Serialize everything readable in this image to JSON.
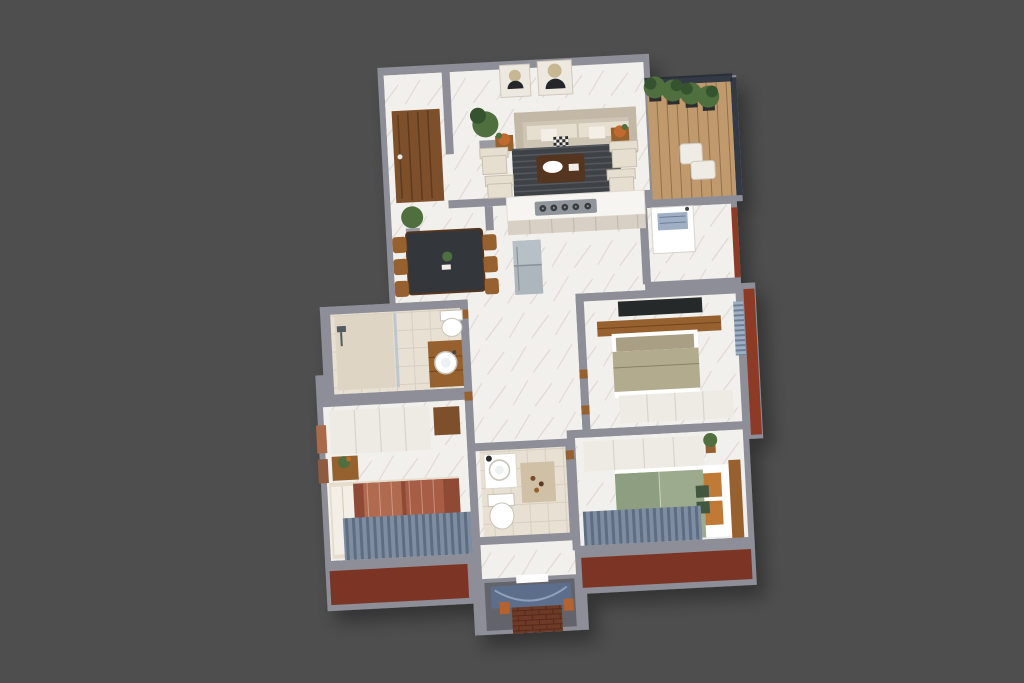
{
  "scene": {
    "description": "3D isometric cutaway floor plan render of a 3-bedroom apartment on a plain gray backdrop",
    "background": "#4e4e4e",
    "rotation_deg": -3,
    "visible_text": "none"
  },
  "palette": {
    "background": "#4e4e4e",
    "wall": "#8e8e98",
    "wall-light": "#b7b7c0",
    "wall-dark": "#6f6f79",
    "floor": "#f2f0ec",
    "floor-vein": "#dcd7d0",
    "floor-tile": "#e8e0d2",
    "tile-line": "#d8cfc0",
    "wood-door": "#7d4f2a",
    "wood-deck": "#c09a6d",
    "wood-dark": "#54351f",
    "wood-mid": "#96602f",
    "terracotta": "#7c3424",
    "brick": "#6e3a28",
    "brick-line": "#58281a",
    "rust-wall": "#8d3b26",
    "sofa": "#cfc5b5",
    "sofa-back": "#c3b8a6",
    "cushion": "#e6dfd0",
    "pillow-white": "#f3efe6",
    "rug-dark": "#3e4246",
    "rug-stripe": "#565b60",
    "rug-beige": "#cfc0a6",
    "table-dark": "#33363a",
    "counter": "#f7f5f1",
    "cabinet": "#d8d0c5",
    "cabinet-line": "#c4bbae",
    "steel": "#aeb6bd",
    "steel-light": "#b8c0c7",
    "hob": "#8f959b",
    "burner": "#3a3d40",
    "bed-rust": "#8f4a36",
    "bed-rust2": "#b06a50",
    "bed-rust3": "#a85e46",
    "bed-sage": "#9cab8d",
    "bed-sage2": "#8e9e80",
    "bed-olive": "#b3ab8e",
    "bed-taupe": "#a89f85",
    "pillow": "#e6ddcc",
    "pillow-orange": "#c07a35",
    "pillow-green": "#41573f",
    "wardrobe": "#eeebe5",
    "wardrobe-line": "#d8d4cc",
    "curtain": "#7f8da1",
    "curtain-dark": "#5f6d83",
    "blind": "#9fb0c4",
    "blind-dark": "#6e7f95",
    "tv": "#26292a",
    "glass": "#232a36",
    "plant": "#4f6f3f",
    "plant-dark": "#35532e",
    "pot-dark": "#2d2d2d",
    "white": "#ffffff",
    "porch-floor": "#63636b",
    "porch-drape": "#5d6e8c",
    "porch-arc": "#8fa0ba",
    "accent-orange": "#b5622f",
    "flower-orange": "#c06a2e",
    "frame": "#eee9e0",
    "frame-line": "#cfc8bb",
    "art-dark": "#24262a",
    "art-tan": "#c7b793",
    "basin-stroke": "#c9c2b6",
    "pot-gray": "#9a9aa0"
  },
  "rooms": [
    {
      "name": "entry-foyer",
      "floor": "white-marble",
      "furniture": [
        "wood-entry-door",
        "potted-plant"
      ]
    },
    {
      "name": "living-room",
      "floor": "white-marble",
      "furniture": [
        "three-seat-sofa",
        "four-armchairs",
        "coffee-table",
        "striped-dark-rug",
        "two-wall-art-frames",
        "two-flower-stands",
        "potted-plant"
      ]
    },
    {
      "name": "balcony",
      "floor": "wood-deck",
      "furniture": [
        "four-potted-trees",
        "lounge-chair",
        "glass-railing"
      ]
    },
    {
      "name": "dining-area",
      "floor": "white-marble",
      "furniture": [
        "dark-stone-dining-table",
        "six-wood-chairs",
        "centerpiece",
        "potted-plant"
      ]
    },
    {
      "name": "kitchen",
      "floor": "white-marble",
      "furniture": [
        "island-counter",
        "five-burner-gas-hob",
        "refrigerator"
      ]
    },
    {
      "name": "utility-room",
      "floor": "white-marble",
      "furniture": [
        "wash-basin-unit"
      ]
    },
    {
      "name": "bedroom-middle",
      "floor": "white-marble",
      "furniture": [
        "wall-tv-panel",
        "wood-media-bench",
        "double-bed-olive",
        "white-wardrobe",
        "window-blinds"
      ]
    },
    {
      "name": "bathroom-main",
      "floor": "beige-tile",
      "furniture": [
        "walk-in-shower",
        "glass-partition",
        "wood-vanity-round-basin",
        "toilet"
      ]
    },
    {
      "name": "bedroom-left",
      "floor": "white-marble",
      "furniture": [
        "white-wardrobe",
        "wood-door",
        "side-table-plant",
        "double-bed-rust",
        "blue-gray-curtains",
        "wall-art"
      ]
    },
    {
      "name": "bathroom-small",
      "floor": "beige-tile",
      "furniture": [
        "white-vanity-round-basin",
        "toilet",
        "beige-rug"
      ]
    },
    {
      "name": "bedroom-right",
      "floor": "white-marble",
      "furniture": [
        "white-wardrobe",
        "double-bed-sage",
        "wood-headboard",
        "orange-and-green-pillows",
        "blue-gray-curtains",
        "corner-plant"
      ]
    },
    {
      "name": "porch-niche",
      "floor": "gray",
      "furniture": [
        "blue-drape",
        "brick-base",
        "white-step"
      ]
    },
    {
      "name": "exterior",
      "features": [
        "terracotta-balcony-floors",
        "rust-red-accent-walls",
        "gray-parapet-walls"
      ]
    }
  ]
}
